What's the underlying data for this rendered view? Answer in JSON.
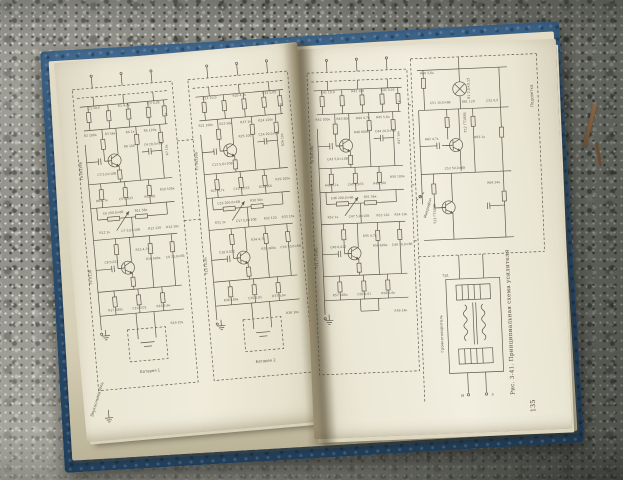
{
  "book": {
    "caption": "Рис. 3-41. Принципиальная схема усилителя",
    "page_number": "135",
    "colors": {
      "cover_blue": "#35608a",
      "page_cream": "#ece7d5",
      "ink": "#46433a",
      "concrete": "#8b8b84"
    },
    "left_page": {
      "input_label": "Звукосниматель",
      "channels": [
        {
          "transistors": [
            "Т6 МП39Б",
            "Т9 П13Б"
          ],
          "battery_label": "Батарея 1",
          "labels": [
            "С1 10,0",
            "R1 4,7к",
            "С2 0,05",
            "а",
            "R2 100к",
            "R3 56к",
            "R4 1к",
            "R5 120к",
            "С3 5,0×10В",
            "R6 100",
            "С4 20,0×6В",
            "R7 10к",
            "R8 4,7к",
            "С5 0,033",
            "R9 560",
            "R10 100к",
            "С6 200,0×6В",
            "R11 56к",
            "R12 1к",
            "С7 5,0×10В",
            "R13 120",
            "R14 10к",
            "С8 0,022",
            "R15 4,7к",
            "R16 600к",
            "С9 30,0×6В",
            "R17 180к",
            "С10 0,01",
            "R18 5,6к",
            "R19 10к"
          ]
        },
        {
          "transistors": [
            "Т7 МП39Б",
            "Т10 П13Б"
          ],
          "battery_label": "Батарея 2",
          "labels": [
            "С11 10,0",
            "R20 4,7к",
            "С12 0,05",
            "б",
            "R21 100к",
            "R22 56к",
            "R23 1к",
            "R24 120к",
            "С13 5,0×10В",
            "R25 100",
            "С14 20,0×6В",
            "R26 10к",
            "R27 4,7к",
            "С15 0,033",
            "R28 560",
            "R29 100к",
            "С16 200,0×6В",
            "R30 56к",
            "R31 1к",
            "С17 5,0×10В",
            "R32 120",
            "R33 10к",
            "С18 0,022",
            "R34 4,7к",
            "R35 600к",
            "С19 30,0×6В",
            "R36 180к",
            "С20 0,01",
            "R37 5,6к",
            "R38 10к"
          ]
        }
      ]
    },
    "right_page": {
      "channel": {
        "transistors": [
          "Т8 МП39Б",
          "Т11 ГТ108Б"
        ],
        "battery_label": "",
        "labels": [
          "С41 10,0",
          "R41 100",
          "С42 0,05",
          "в",
          "R42 100к",
          "R43 60к",
          "R44 4,7к",
          "R45 5,6к",
          "С43 5,0×10В",
          "R46 600к",
          "С44 20,0×6В",
          "R47 10к",
          "R48 4,7к",
          "С45 0,033",
          "R49 560",
          "R50 100к",
          "С46 200,0×6В",
          "R51 56к",
          "R52 1к",
          "С47 5,0×10В",
          "R53 120",
          "R54 10к",
          "С48 0,022",
          "R55 4,7к",
          "R56 600к",
          "С49 30,0×6В",
          "R57 180к",
          "С50 0,01",
          "R58 5,6к",
          "R59 24к"
        ]
      },
      "output": {
        "transistor_labels": [
          "Т12 ГТ108Б",
          "Т13 ГТ403Б"
        ],
        "lamp_label": "Л1 2,5×0,15",
        "backlight_label": "Подсветка",
        "microphone_label": "Микрофон",
        "speaker_label": "Громкоговоритель",
        "transformer_label": "Тр1",
        "terminal_labels": [
          "М",
          "З"
        ],
        "labels": [
          "R60 5,6к",
          "С51 10,0×6В",
          "R61 120",
          "С52 0,5",
          "R62 4,7к",
          "R63 1к",
          "С53 50,0×6В",
          "R64 24к"
        ]
      }
    }
  }
}
